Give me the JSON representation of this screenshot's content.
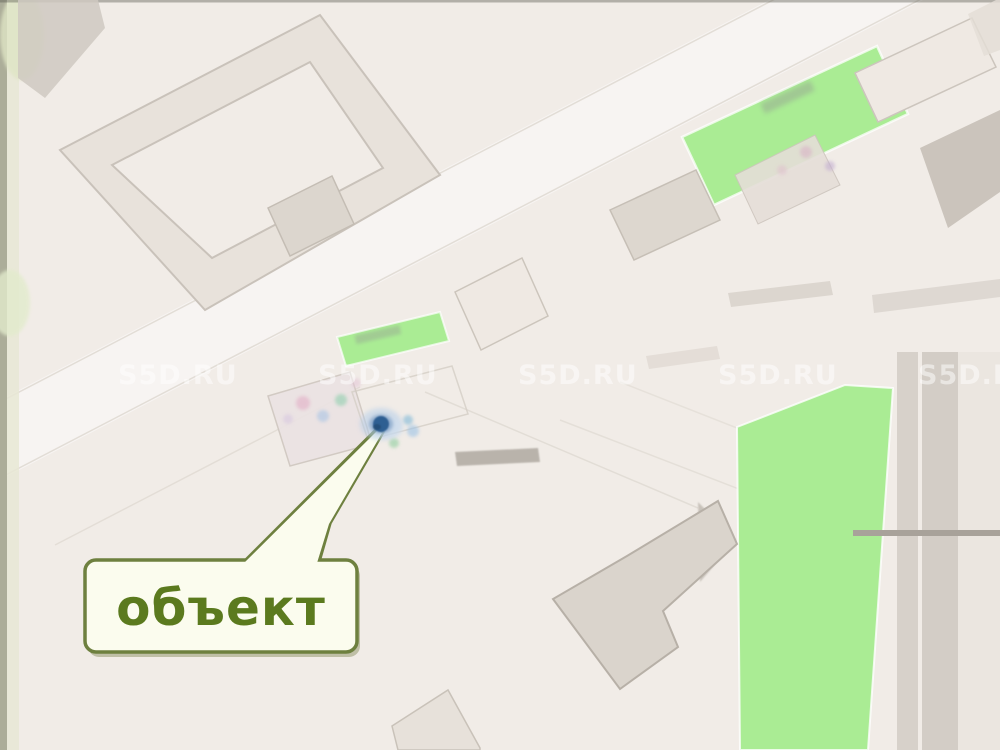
{
  "map": {
    "callout": {
      "label": "объект"
    },
    "watermark": {
      "text": "S5D.RU",
      "row_y": 384,
      "positions_x": [
        118,
        318,
        518,
        718,
        918
      ]
    },
    "marker": {
      "x": 381,
      "y": 424
    },
    "colors": {
      "background": "#f1ece7",
      "road": "#f7f4f2",
      "building_fill": "#dcd6ce",
      "building_outline": "#c9c2ba",
      "green_area": "#aaec94",
      "callout_border": "#6e803f",
      "callout_fill": "#fbfcee",
      "callout_text": "#5b7a1e",
      "marker_core": "#2f5e92",
      "marker_halo": "#b4cde9",
      "watermark_color": "#ffffff"
    }
  }
}
